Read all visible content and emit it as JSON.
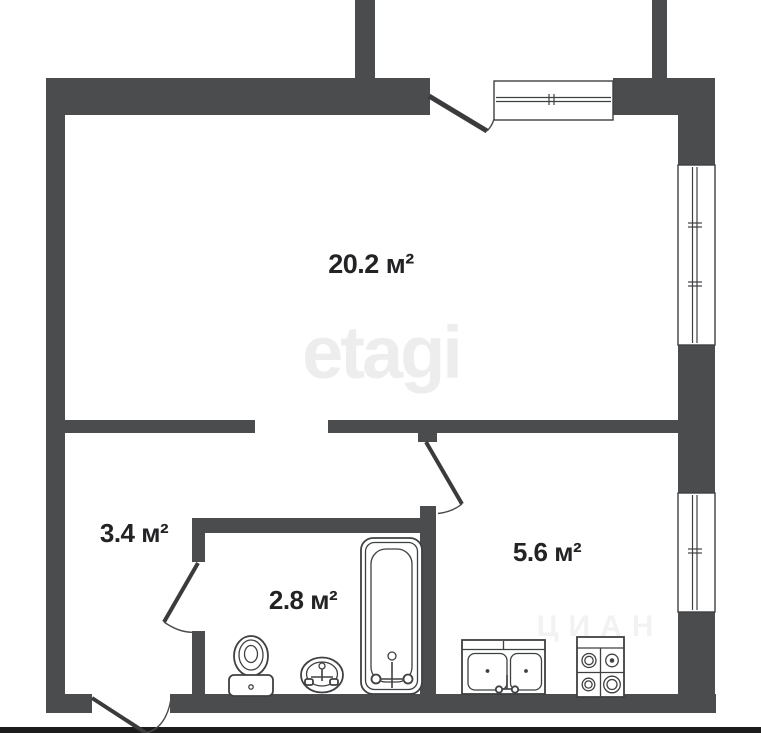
{
  "plan": {
    "title": "Apartment floor plan",
    "background_color": "#ffffff",
    "wall_color": "#4b4c4e",
    "line_color": "#3f4042",
    "baseline_color": "#1c1c1c",
    "rooms": [
      {
        "name": "living-room",
        "area_label": "20.2 м²"
      },
      {
        "name": "hallway",
        "area_label": "3.4 м²"
      },
      {
        "name": "bathroom",
        "area_label": "2.8 м²"
      },
      {
        "name": "kitchen",
        "area_label": "5.6 м²"
      }
    ],
    "openings": [
      {
        "name": "balcony-door"
      },
      {
        "name": "balcony-window"
      },
      {
        "name": "living-room-window"
      },
      {
        "name": "kitchen-window"
      },
      {
        "name": "living-room-doorway"
      },
      {
        "name": "bathroom-door"
      },
      {
        "name": "kitchen-door"
      },
      {
        "name": "entrance-door"
      }
    ],
    "fixtures": [
      {
        "name": "toilet"
      },
      {
        "name": "wash-basin"
      },
      {
        "name": "bathtub"
      },
      {
        "name": "kitchen-sink"
      },
      {
        "name": "stove"
      }
    ],
    "watermark": {
      "text": "etagi",
      "color": "#ededed"
    },
    "watermark_secondary": {
      "text": "ЦИАН"
    }
  }
}
